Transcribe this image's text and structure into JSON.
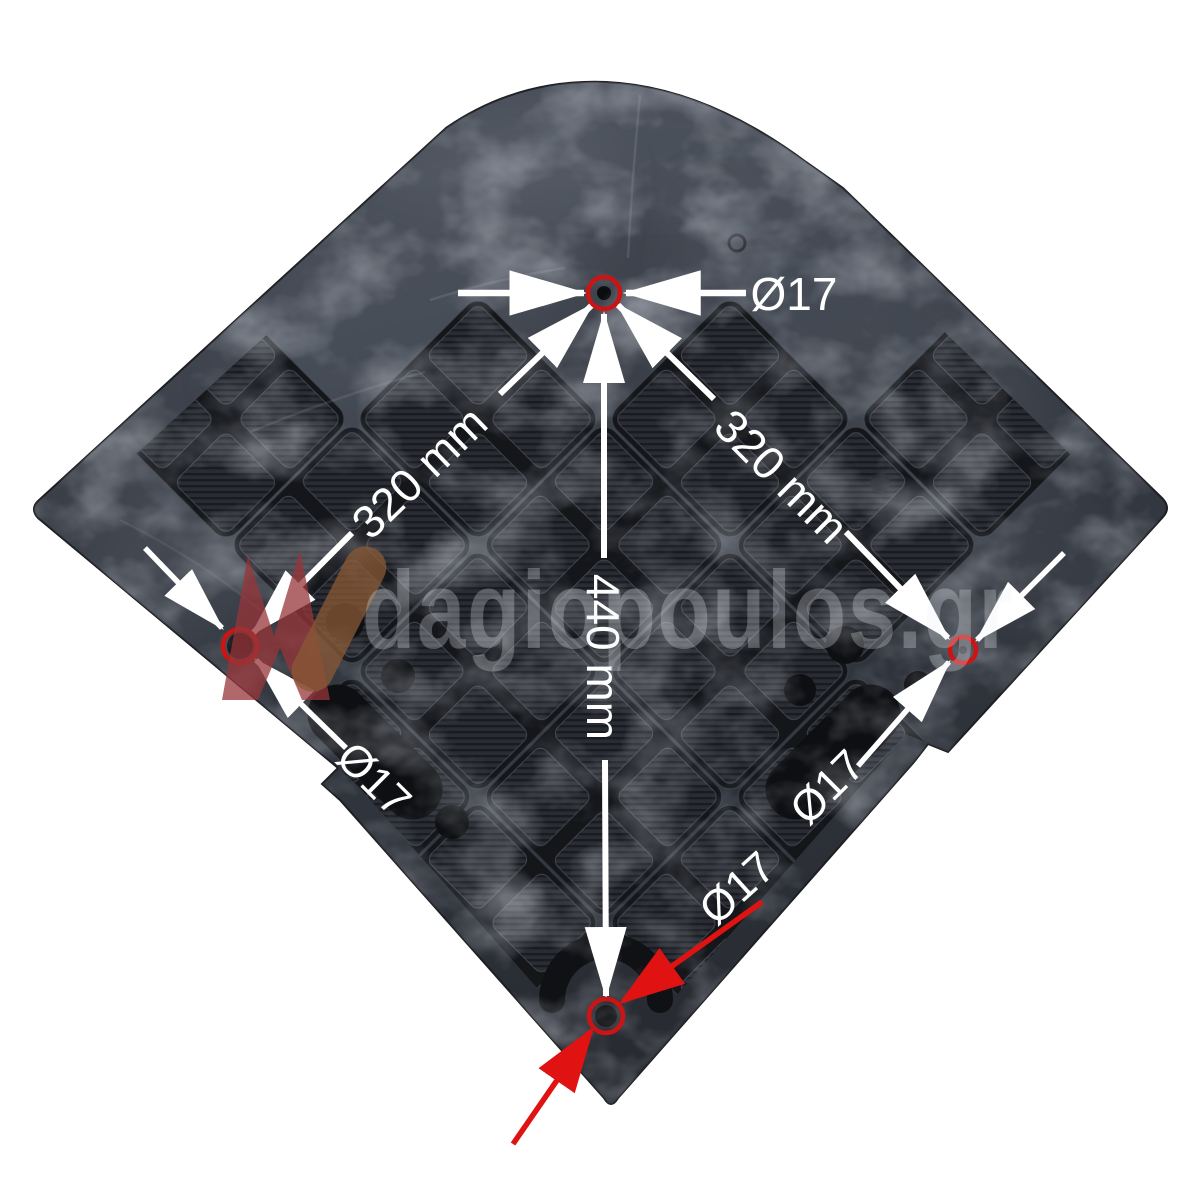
{
  "image": {
    "description": "black rubber pad with diamond tread pattern, four mounting holes circled in red, annotated with dimensions"
  },
  "watermark": {
    "text": "dagiopoulos.gr"
  },
  "annotations": {
    "diameter_labels": {
      "top": "Ø17",
      "left": "Ø17",
      "right": "Ø17",
      "bottom": "Ø17"
    },
    "distance_labels": {
      "top_to_left": "320 mm",
      "top_to_right": "320 mm",
      "top_to_bottom": "440 mm"
    }
  },
  "colors": {
    "background": "#ffffff",
    "pad_dark": "#363a42",
    "annotation_white": "#ffffff",
    "hole_marker_red": "#cc1414",
    "pointer_arrow_red": "#e01212",
    "watermark_logo_red": "#97353a",
    "watermark_logo_brown": "#8a5a35"
  }
}
